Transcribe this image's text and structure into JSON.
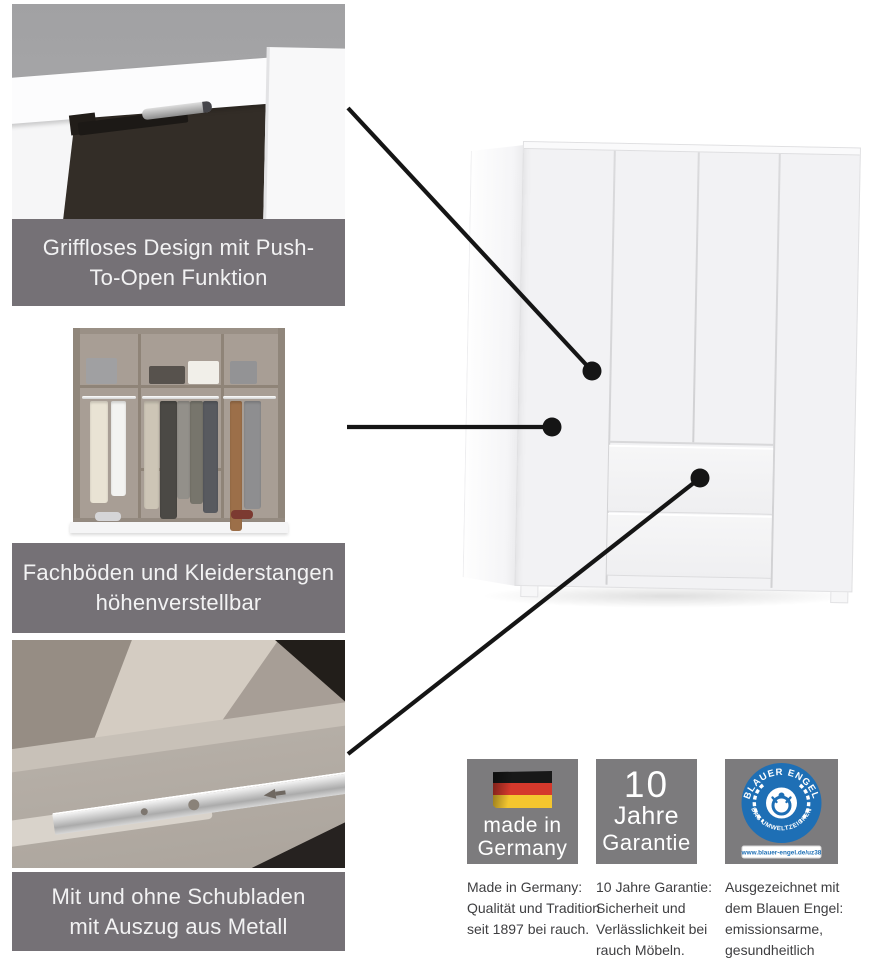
{
  "panels": [
    {
      "caption": [
        "Griffloses Design mit Push-",
        "To-Open Funktion"
      ]
    },
    {
      "caption": [
        "Fachböden und Kleiderstangen",
        "höhenverstellbar"
      ]
    },
    {
      "caption": [
        "Mit und ohne Schubladen",
        "mit Auszug aus Metall"
      ]
    }
  ],
  "badges": {
    "made_in_germany": {
      "label": [
        "made in",
        "Germany"
      ],
      "caption": [
        "Made in Germany:",
        "Qualität und Tradition",
        "seit 1897 bei rauch."
      ]
    },
    "garantie": {
      "label": [
        "10",
        "Jahre",
        "Garantie"
      ],
      "caption": [
        "10 Jahre Garantie:",
        "Sicherheit und",
        "Verlässlichkeit bei",
        "rauch Möbeln."
      ]
    },
    "blauer_engel": {
      "ring_top": "BLAUER ENGEL",
      "ring_bottom": "DAS UMWELTZEICHEN",
      "url": "www.blauer-engel.de/uz38",
      "caption": [
        "Ausgezeichnet mit",
        "dem Blauen Engel:",
        "emissionsarme,",
        "gesundheitlich",
        "unbedenkliche Möbel."
      ]
    }
  },
  "colors": {
    "caption_bar_gray": "#757176",
    "badge_gray": "#7c7b7d",
    "engel_blue": "#1e6fb5",
    "flag_black": "#181818",
    "flag_red": "#d5392c",
    "flag_gold": "#f4c62f",
    "callout_black": "#151515"
  }
}
